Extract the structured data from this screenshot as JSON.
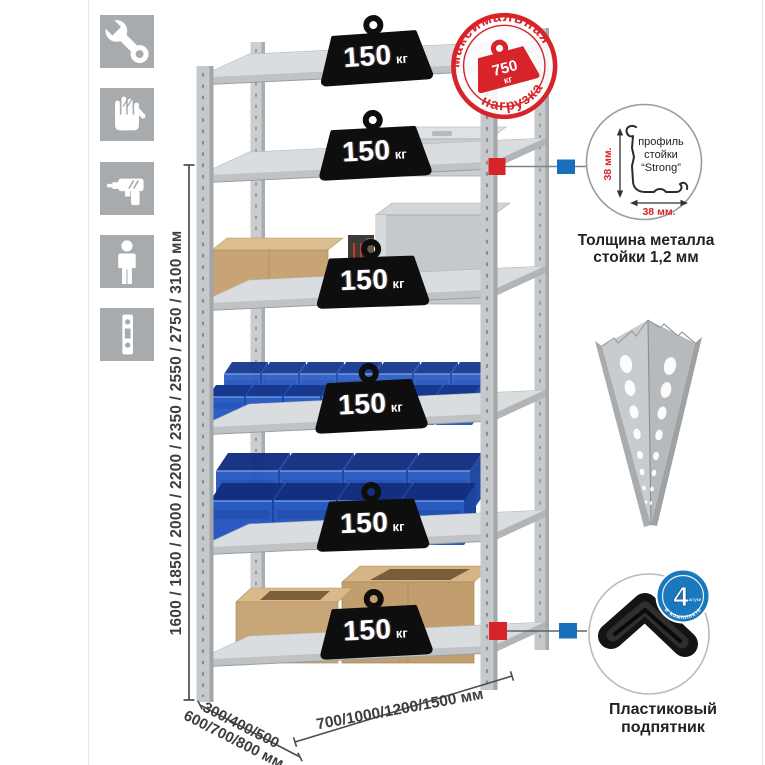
{
  "colors": {
    "accent_red": "#d8232a",
    "accent_blue": "#1a6fbd",
    "icon_gray": "#a8abad",
    "metal_gray": "#c6c9cb",
    "bin_blue": "#2d5ec6",
    "cardboard": "#c8a475",
    "weight_black": "#0e0e0e"
  },
  "assembly_icons": [
    {
      "name": "wrench-icon"
    },
    {
      "name": "gloves-icon"
    },
    {
      "name": "drill-icon"
    },
    {
      "name": "person-icon"
    },
    {
      "name": "perforated-post-icon"
    }
  ],
  "stamp": {
    "arc_top": "максимальная",
    "arc_bottom": "нагрузка",
    "value": "750",
    "unit": "кг"
  },
  "shelves": {
    "count": 6,
    "load": {
      "value": "150",
      "unit": "кг"
    }
  },
  "dimensions": {
    "height": "1600 / 1850 / 2000 / 2200 / 2350 / 2550 / 2750 / 3100 мм",
    "depth_top": "300/400/500",
    "depth_bottom": "600/700/800 мм",
    "width": "700/1000/1200/1500 мм"
  },
  "profile_detail": {
    "label_line1": "профиль",
    "label_line2": "стойки",
    "label_line3": "“Strong”",
    "dim_vertical": "38 мм.",
    "dim_horizontal": "38 мм.",
    "caption_line1": "Толщина металла",
    "caption_line2": "стойки 1,2 мм"
  },
  "foot_detail": {
    "badge_number": "4",
    "badge_small": "штуки",
    "badge_arc": "в комплекте",
    "caption_line1": "Пластиковый",
    "caption_line2": "подпятник"
  }
}
